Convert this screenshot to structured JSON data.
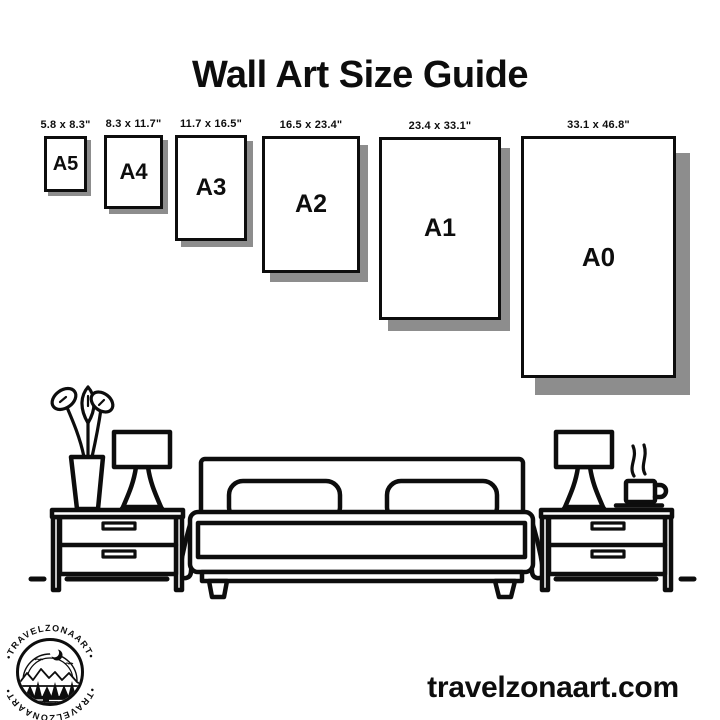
{
  "title": "Wall Art Size Guide",
  "sizes": [
    {
      "name": "A5",
      "dimensions": "5.8 x 8.3\""
    },
    {
      "name": "A4",
      "dimensions": "8.3 x 11.7\""
    },
    {
      "name": "A3",
      "dimensions": "11.7 x 16.5\""
    },
    {
      "name": "A2",
      "dimensions": "16.5 x 23.4\""
    },
    {
      "name": "A1",
      "dimensions": "23.4 x 33.1\""
    },
    {
      "name": "A0",
      "dimensions": "33.1 x 46.8\""
    }
  ],
  "footer": {
    "website": "travelzonaart.com"
  },
  "logo": {
    "brand_top": "•TRAVELZONAART•",
    "brand_bottom": "•TRAVELZONAART•"
  },
  "colors": {
    "ink": "#0d0d0d",
    "shadow": "#8d8d8d",
    "background": "#ffffff"
  }
}
